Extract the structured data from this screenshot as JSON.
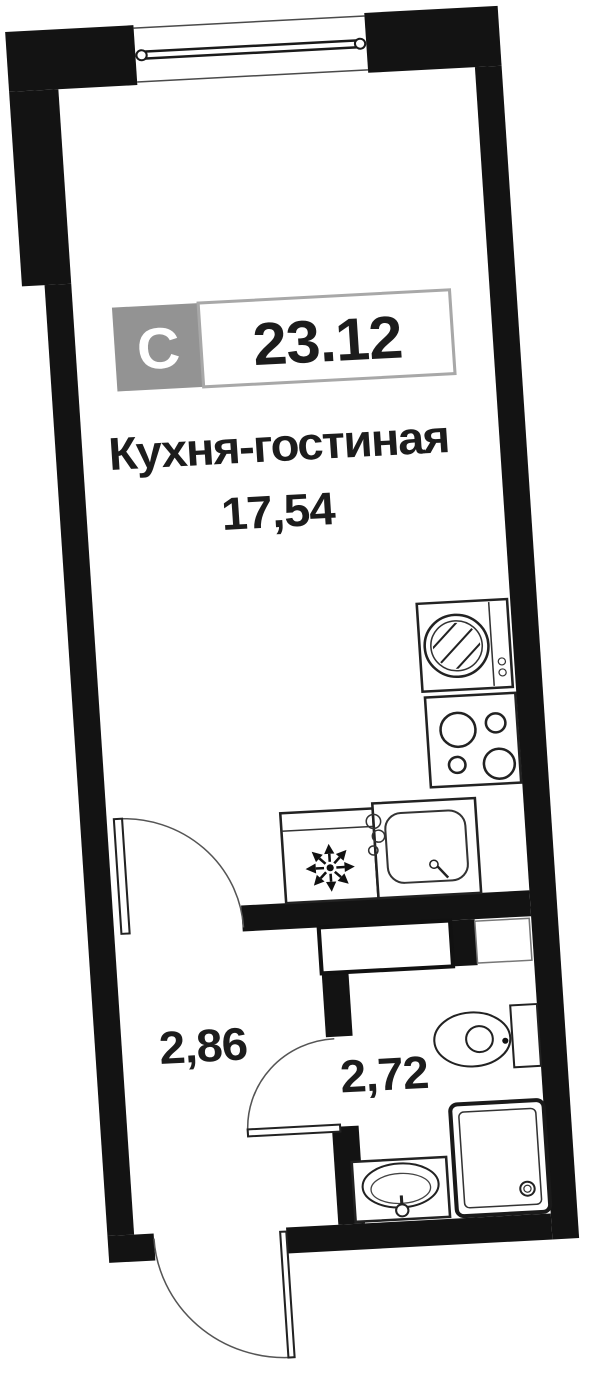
{
  "plan": {
    "type": "studio-floor-plan",
    "badge": {
      "letter": "С",
      "total_area": "23.12"
    },
    "rooms": {
      "kitchen_living": {
        "name": "Кухня-гостиная",
        "area": "17,54"
      },
      "hallway": {
        "area": "2,86"
      },
      "bathroom": {
        "area": "2,72"
      }
    },
    "fixtures": {
      "window": "window-double-glazing",
      "washing_machine": "washing-machine-drum",
      "cooktop": "cooktop-4-burners",
      "fridge": "fridge-snowflake",
      "kitchen_sink": "kitchen-sink-with-faucet",
      "toilet": "toilet-with-cistern",
      "shower": "shower-tray-with-drain",
      "bath_sink": "washbasin-with-faucet",
      "duct": "ventilation-duct-box",
      "shelf": "bathroom-shelf",
      "doors": [
        "entrance-door-arc",
        "kitchen-door-arc",
        "bathroom-door-arc"
      ]
    },
    "colors": {
      "background": "#ffffff",
      "wall": "#131313",
      "line": "#2a2a2a",
      "arc": "#555555",
      "badge_bg": "#939393",
      "badge_letter": "#ffffff",
      "area_box_border": "#a8a8a8",
      "text": "#1c1c1c"
    }
  }
}
